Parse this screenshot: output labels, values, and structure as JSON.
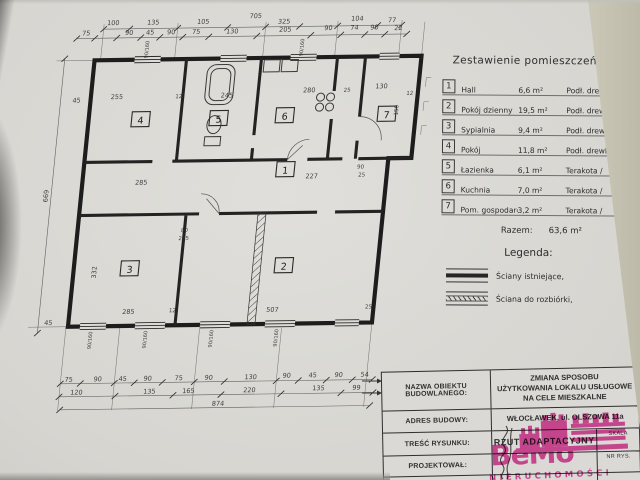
{
  "document": {
    "schedule": {
      "title": "Zestawienie pomieszczeń:",
      "rows": [
        {
          "no": "1",
          "name": "Hall",
          "area": "6,6 m²",
          "floor": "Podł. drewl."
        },
        {
          "no": "2",
          "name": "Pokój dzienny",
          "area": "19,5 m²",
          "floor": "Podł. drewl."
        },
        {
          "no": "3",
          "name": "Sypialnia",
          "area": "9,4 m²",
          "floor": "Podł. drewl."
        },
        {
          "no": "4",
          "name": "Pokój",
          "area": "11,8 m²",
          "floor": "Podł. drewl."
        },
        {
          "no": "5",
          "name": "Łazienka",
          "area": "6,1 m²",
          "floor": "Terakota /"
        },
        {
          "no": "6",
          "name": "Kuchnia",
          "area": "7,0 m²",
          "floor": "Terakota /"
        },
        {
          "no": "7",
          "name": "Pom. gospodarcze",
          "area": "3,2 m²",
          "floor": "Terakota /"
        }
      ],
      "total_label": "Razem:",
      "total_value": "63,6 m²"
    },
    "legend": {
      "title": "Legenda:",
      "items": [
        {
          "label": "Ściany istniejące,"
        },
        {
          "label": "Ściana do rozbiórki,"
        }
      ]
    },
    "title_block": {
      "name_label": "NAZWA OBIEKTU BUDOWLANEGO:",
      "name_value": "ZMIANA SPOSOBU\nUŻYTKOWANIA LOKALU USŁUGOWE\nNA CELE MIESZKALNE",
      "address_label": "ADRES BUDOWY:",
      "address_value": "WŁOCŁAWEK, ul. OLSZOWA 11a",
      "drawing_label": "TREŚĆ RYSUNKU:",
      "drawing_value": "RZUT ADAPTACYJNY",
      "designer_label": "PROJEKTOWAŁ:",
      "date": "PAŹDZIERNIK 2000",
      "scale_label": "SKALA",
      "dwg_no_label": "NR RYS."
    },
    "watermark": {
      "brand": "BeMo",
      "subtitle": "NIERUCHOMOŚCI",
      "color": "#e2399c"
    },
    "plan": {
      "rooms": [
        {
          "no": "1",
          "x": 302,
          "y": 170
        },
        {
          "no": "2",
          "x": 310,
          "y": 266
        },
        {
          "no": "3",
          "x": 156,
          "y": 267
        },
        {
          "no": "4",
          "x": 152,
          "y": 118
        },
        {
          "no": "5",
          "x": 230,
          "y": 118
        },
        {
          "no": "6",
          "x": 296,
          "y": 116
        },
        {
          "no": "7",
          "x": 398,
          "y": 116
        }
      ],
      "dims": [
        {
          "x": 115,
          "y": 23,
          "t": "100"
        },
        {
          "x": 155,
          "y": 23,
          "t": "135"
        },
        {
          "x": 205,
          "y": 23,
          "t": "105"
        },
        {
          "x": 257,
          "y": 18,
          "t": "705"
        },
        {
          "x": 286,
          "y": 24,
          "t": "325"
        },
        {
          "x": 359,
          "y": 22,
          "t": "104"
        },
        {
          "x": 394,
          "y": 24,
          "t": "77"
        },
        {
          "x": 89,
          "y": 33,
          "t": "75"
        },
        {
          "x": 132,
          "y": 33,
          "t": "90"
        },
        {
          "x": 153,
          "y": 33,
          "t": "45"
        },
        {
          "x": 174,
          "y": 33,
          "t": "90"
        },
        {
          "x": 199,
          "y": 33,
          "t": "75"
        },
        {
          "x": 235,
          "y": 33,
          "t": "130"
        },
        {
          "x": 288,
          "y": 32,
          "t": "205"
        },
        {
          "x": 331,
          "y": 31,
          "t": "90"
        },
        {
          "x": 357,
          "y": 31,
          "t": "74"
        },
        {
          "x": 377,
          "y": 31,
          "t": "90"
        },
        {
          "x": 401,
          "y": 32,
          "t": "22"
        },
        {
          "x": 106,
          "y": 379,
          "t": "75"
        },
        {
          "x": 135,
          "y": 379,
          "t": "90"
        },
        {
          "x": 160,
          "y": 379,
          "t": "45"
        },
        {
          "x": 185,
          "y": 379,
          "t": "90"
        },
        {
          "x": 216,
          "y": 379,
          "t": "75"
        },
        {
          "x": 246,
          "y": 379,
          "t": "90"
        },
        {
          "x": 288,
          "y": 379,
          "t": "130"
        },
        {
          "x": 324,
          "y": 378,
          "t": "90"
        },
        {
          "x": 350,
          "y": 378,
          "t": "45"
        },
        {
          "x": 376,
          "y": 378,
          "t": "90"
        },
        {
          "x": 402,
          "y": 378,
          "t": "54"
        },
        {
          "x": 115,
          "y": 392,
          "t": "120"
        },
        {
          "x": 188,
          "y": 392,
          "t": "135"
        },
        {
          "x": 227,
          "y": 392,
          "t": "165"
        },
        {
          "x": 288,
          "y": 392,
          "t": "220"
        },
        {
          "x": 357,
          "y": 391,
          "t": "135"
        },
        {
          "x": 395,
          "y": 391,
          "t": "99"
        },
        {
          "x": 258,
          "y": 405,
          "t": "874"
        },
        {
          "x": 67,
          "y": 193,
          "t": "669",
          "r": -90
        },
        {
          "x": 86,
          "y": 100,
          "t": "45"
        },
        {
          "x": 80,
          "y": 322,
          "t": "45"
        },
        {
          "x": 126,
          "y": 97,
          "t": "255"
        },
        {
          "x": 188,
          "y": 97,
          "t": "12",
          "s": 5.5
        },
        {
          "x": 236,
          "y": 97,
          "t": "245"
        },
        {
          "x": 318,
          "y": 93,
          "t": "280"
        },
        {
          "x": 356,
          "y": 93,
          "t": "25",
          "s": 5.5
        },
        {
          "x": 390,
          "y": 90,
          "t": "130"
        },
        {
          "x": 419,
          "y": 97,
          "t": "12",
          "s": 5.5
        },
        {
          "x": 159,
          "y": 183,
          "t": "285"
        },
        {
          "x": 329,
          "y": 179,
          "t": "227"
        },
        {
          "x": 123,
          "y": 270,
          "t": "332",
          "r": -90
        },
        {
          "x": 159,
          "y": 312,
          "t": "285"
        },
        {
          "x": 203,
          "y": 311,
          "t": "12",
          "s": 5.5
        },
        {
          "x": 303,
          "y": 312,
          "t": "507"
        },
        {
          "x": 399,
          "y": 310,
          "t": "25",
          "s": 5.5
        },
        {
          "x": 207,
          "y": 231,
          "t": "80",
          "s": 5.5
        },
        {
          "x": 207,
          "y": 239,
          "t": "205",
          "s": 5.5
        },
        {
          "x": 377,
          "y": 170,
          "t": "90",
          "s": 5.5
        },
        {
          "x": 379,
          "y": 178,
          "t": "25",
          "s": 5.5
        },
        {
          "x": 409,
          "y": 112,
          "t": "150",
          "r": -90,
          "s": 5.5
        },
        {
          "x": 125,
          "y": 338,
          "t": "90/160",
          "r": -90,
          "s": 5
        },
        {
          "x": 180,
          "y": 338,
          "t": "90/160",
          "r": -90,
          "s": 5
        },
        {
          "x": 246,
          "y": 338,
          "t": "90/160",
          "r": -90,
          "s": 5
        },
        {
          "x": 311,
          "y": 338,
          "t": "90/160",
          "r": -90,
          "s": 5
        },
        {
          "x": 153,
          "y": 48,
          "t": "90/160",
          "r": -90,
          "s": 5
        },
        {
          "x": 308,
          "y": 48,
          "t": "90/160",
          "r": -90,
          "s": 5
        }
      ],
      "chains": [
        {
          "y": 27,
          "x1": 106,
          "x2": 404,
          "xs": [
            106,
            132,
            180,
            230,
            268,
            302,
            340,
            380,
            404
          ]
        },
        {
          "y": 36,
          "x1": 80,
          "x2": 410,
          "xs": [
            80,
            98,
            120,
            144,
            163,
            186,
            212,
            260,
            314,
            344,
            368,
            388,
            410
          ]
        },
        {
          "y": 381,
          "x1": 98,
          "x2": 410,
          "xs": [
            98,
            118,
            152,
            172,
            200,
            232,
            262,
            314,
            336,
            364,
            390,
            410
          ]
        },
        {
          "y": 394,
          "x1": 98,
          "x2": 412,
          "xs": [
            98,
            154,
            212,
            260,
            320,
            380,
            412
          ]
        },
        {
          "y": 407,
          "x1": 100,
          "x2": 410,
          "xs": [
            100,
            410
          ]
        },
        {
          "x": 70,
          "y1": 56,
          "y2": 330,
          "ys": [
            56,
            330
          ],
          "vertical": true
        }
      ]
    }
  }
}
